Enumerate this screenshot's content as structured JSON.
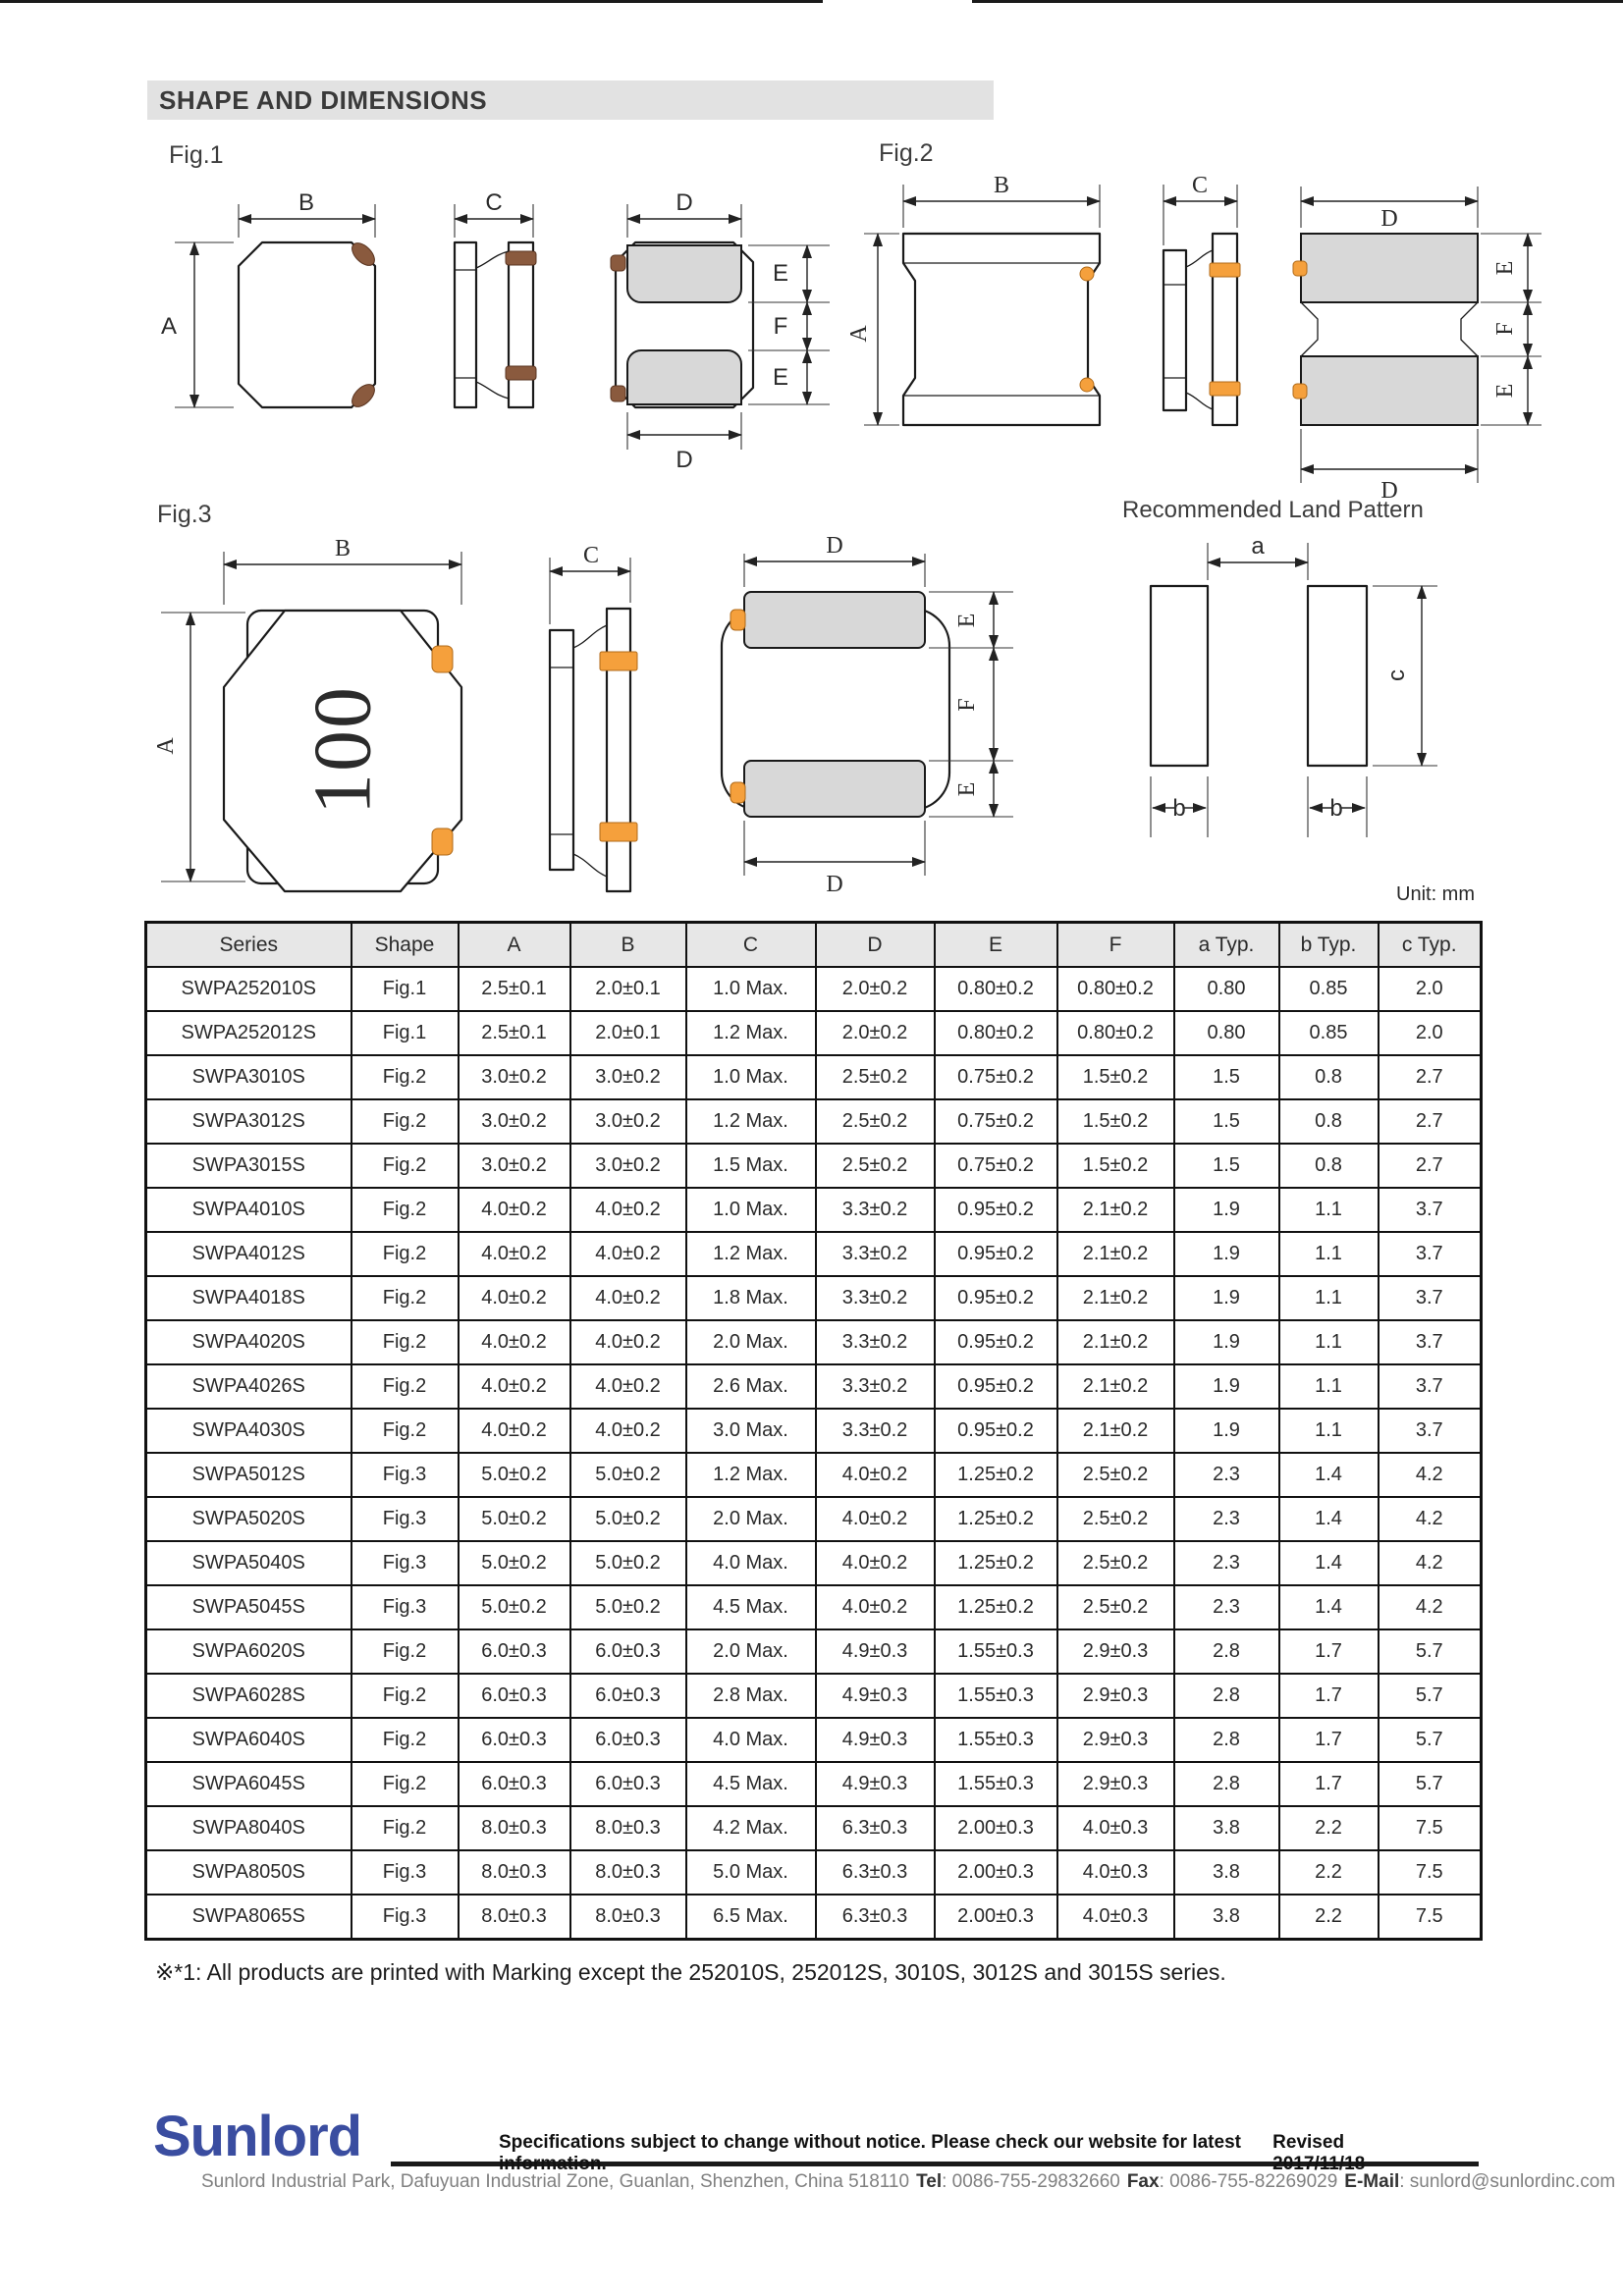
{
  "page": {
    "title": "SHAPE AND DIMENSIONS",
    "unit_label": "Unit: mm",
    "footnote": "※*1: All products are printed with Marking except the 252010S, 252012S, 3010S, 3012S and 3015S series."
  },
  "dims": {
    "A": "A",
    "B": "B",
    "C": "C",
    "D": "D",
    "E": "E",
    "F": "F",
    "a": "a",
    "b": "b",
    "c": "c"
  },
  "figures": {
    "fig1_label": "Fig.1",
    "fig2_label": "Fig.2",
    "fig3_label": "Fig.3",
    "land_pattern_label": "Recommended Land Pattern",
    "fig3_marking": "100"
  },
  "table": {
    "headers": [
      "Series",
      "Shape",
      "A",
      "B",
      "C",
      "D",
      "E",
      "F",
      "a Typ.",
      "b Typ.",
      "c Typ."
    ],
    "rows": [
      [
        "SWPA252010S",
        "Fig.1",
        "2.5±0.1",
        "2.0±0.1",
        "1.0 Max.",
        "2.0±0.2",
        "0.80±0.2",
        "0.80±0.2",
        "0.80",
        "0.85",
        "2.0"
      ],
      [
        "SWPA252012S",
        "Fig.1",
        "2.5±0.1",
        "2.0±0.1",
        "1.2 Max.",
        "2.0±0.2",
        "0.80±0.2",
        "0.80±0.2",
        "0.80",
        "0.85",
        "2.0"
      ],
      [
        "SWPA3010S",
        "Fig.2",
        "3.0±0.2",
        "3.0±0.2",
        "1.0 Max.",
        "2.5±0.2",
        "0.75±0.2",
        "1.5±0.2",
        "1.5",
        "0.8",
        "2.7"
      ],
      [
        "SWPA3012S",
        "Fig.2",
        "3.0±0.2",
        "3.0±0.2",
        "1.2 Max.",
        "2.5±0.2",
        "0.75±0.2",
        "1.5±0.2",
        "1.5",
        "0.8",
        "2.7"
      ],
      [
        "SWPA3015S",
        "Fig.2",
        "3.0±0.2",
        "3.0±0.2",
        "1.5 Max.",
        "2.5±0.2",
        "0.75±0.2",
        "1.5±0.2",
        "1.5",
        "0.8",
        "2.7"
      ],
      [
        "SWPA4010S",
        "Fig.2",
        "4.0±0.2",
        "4.0±0.2",
        "1.0 Max.",
        "3.3±0.2",
        "0.95±0.2",
        "2.1±0.2",
        "1.9",
        "1.1",
        "3.7"
      ],
      [
        "SWPA4012S",
        "Fig.2",
        "4.0±0.2",
        "4.0±0.2",
        "1.2 Max.",
        "3.3±0.2",
        "0.95±0.2",
        "2.1±0.2",
        "1.9",
        "1.1",
        "3.7"
      ],
      [
        "SWPA4018S",
        "Fig.2",
        "4.0±0.2",
        "4.0±0.2",
        "1.8 Max.",
        "3.3±0.2",
        "0.95±0.2",
        "2.1±0.2",
        "1.9",
        "1.1",
        "3.7"
      ],
      [
        "SWPA4020S",
        "Fig.2",
        "4.0±0.2",
        "4.0±0.2",
        "2.0 Max.",
        "3.3±0.2",
        "0.95±0.2",
        "2.1±0.2",
        "1.9",
        "1.1",
        "3.7"
      ],
      [
        "SWPA4026S",
        "Fig.2",
        "4.0±0.2",
        "4.0±0.2",
        "2.6 Max.",
        "3.3±0.2",
        "0.95±0.2",
        "2.1±0.2",
        "1.9",
        "1.1",
        "3.7"
      ],
      [
        "SWPA4030S",
        "Fig.2",
        "4.0±0.2",
        "4.0±0.2",
        "3.0 Max.",
        "3.3±0.2",
        "0.95±0.2",
        "2.1±0.2",
        "1.9",
        "1.1",
        "3.7"
      ],
      [
        "SWPA5012S",
        "Fig.3",
        "5.0±0.2",
        "5.0±0.2",
        "1.2 Max.",
        "4.0±0.2",
        "1.25±0.2",
        "2.5±0.2",
        "2.3",
        "1.4",
        "4.2"
      ],
      [
        "SWPA5020S",
        "Fig.3",
        "5.0±0.2",
        "5.0±0.2",
        "2.0 Max.",
        "4.0±0.2",
        "1.25±0.2",
        "2.5±0.2",
        "2.3",
        "1.4",
        "4.2"
      ],
      [
        "SWPA5040S",
        "Fig.3",
        "5.0±0.2",
        "5.0±0.2",
        "4.0 Max.",
        "4.0±0.2",
        "1.25±0.2",
        "2.5±0.2",
        "2.3",
        "1.4",
        "4.2"
      ],
      [
        "SWPA5045S",
        "Fig.3",
        "5.0±0.2",
        "5.0±0.2",
        "4.5 Max.",
        "4.0±0.2",
        "1.25±0.2",
        "2.5±0.2",
        "2.3",
        "1.4",
        "4.2"
      ],
      [
        "SWPA6020S",
        "Fig.2",
        "6.0±0.3",
        "6.0±0.3",
        "2.0 Max.",
        "4.9±0.3",
        "1.55±0.3",
        "2.9±0.3",
        "2.8",
        "1.7",
        "5.7"
      ],
      [
        "SWPA6028S",
        "Fig.2",
        "6.0±0.3",
        "6.0±0.3",
        "2.8 Max.",
        "4.9±0.3",
        "1.55±0.3",
        "2.9±0.3",
        "2.8",
        "1.7",
        "5.7"
      ],
      [
        "SWPA6040S",
        "Fig.2",
        "6.0±0.3",
        "6.0±0.3",
        "4.0 Max.",
        "4.9±0.3",
        "1.55±0.3",
        "2.9±0.3",
        "2.8",
        "1.7",
        "5.7"
      ],
      [
        "SWPA6045S",
        "Fig.2",
        "6.0±0.3",
        "6.0±0.3",
        "4.5 Max.",
        "4.9±0.3",
        "1.55±0.3",
        "2.9±0.3",
        "2.8",
        "1.7",
        "5.7"
      ],
      [
        "SWPA8040S",
        "Fig.2",
        "8.0±0.3",
        "8.0±0.3",
        "4.2 Max.",
        "6.3±0.3",
        "2.00±0.3",
        "4.0±0.3",
        "3.8",
        "2.2",
        "7.5"
      ],
      [
        "SWPA8050S",
        "Fig.3",
        "8.0±0.3",
        "8.0±0.3",
        "5.0 Max.",
        "6.3±0.3",
        "2.00±0.3",
        "4.0±0.3",
        "3.8",
        "2.2",
        "7.5"
      ],
      [
        "SWPA8065S",
        "Fig.3",
        "8.0±0.3",
        "8.0±0.3",
        "6.5 Max.",
        "6.3±0.3",
        "2.00±0.3",
        "4.0±0.3",
        "3.8",
        "2.2",
        "7.5"
      ]
    ]
  },
  "footer": {
    "logo": "Sunlord",
    "notice": "Specifications subject to change without notice. Please check our website for latest information.",
    "revised": "Revised 2017/11/18",
    "address": {
      "location": "Sunlord Industrial Park, Dafuyuan Industrial Zone, Guanlan, Shenzhen, China 518110",
      "tel_label": "Tel",
      "tel_value": ": 0086-755-29832660",
      "fax_label": "Fax",
      "fax_value": ": 0086-755-82269029",
      "email_label": "E-Mail",
      "email_value": ": sunlord@sunlordinc.com"
    }
  },
  "colors": {
    "logo_blue": "#3a4da0",
    "terminal_orange": "#f5a03c",
    "terminal_brown": "#8a5a3e",
    "pad_gray": "#d8d8d8",
    "header_gray": "#e7e7e7"
  }
}
